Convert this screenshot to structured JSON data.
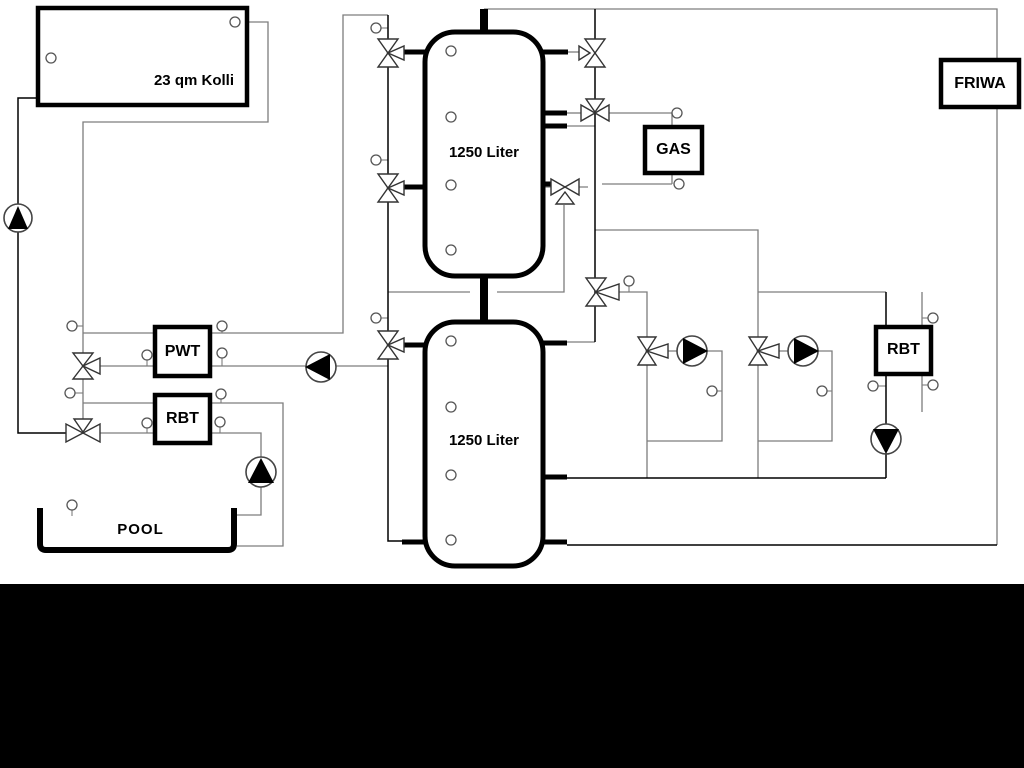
{
  "labels": {
    "collector": "23 qm Kolli",
    "tank_upper": "1250 Liter",
    "tank_lower": "1250 Liter",
    "pwt": "PWT",
    "rbt_left": "RBT",
    "gas": "GAS",
    "friwa": "FRIWA",
    "rbt_right": "RBT",
    "pool": "POOL"
  },
  "icons": {
    "pump": "circle-with-solid-triangle",
    "three_way_valve": "double-triangle-bowtie-with-branch",
    "sensor": "small-circle-with-stem"
  },
  "colors": {
    "pipe_gray": "#7d7d7d",
    "pipe_black": "#000000",
    "background": "#ffffff",
    "footer_band": "#000000"
  }
}
